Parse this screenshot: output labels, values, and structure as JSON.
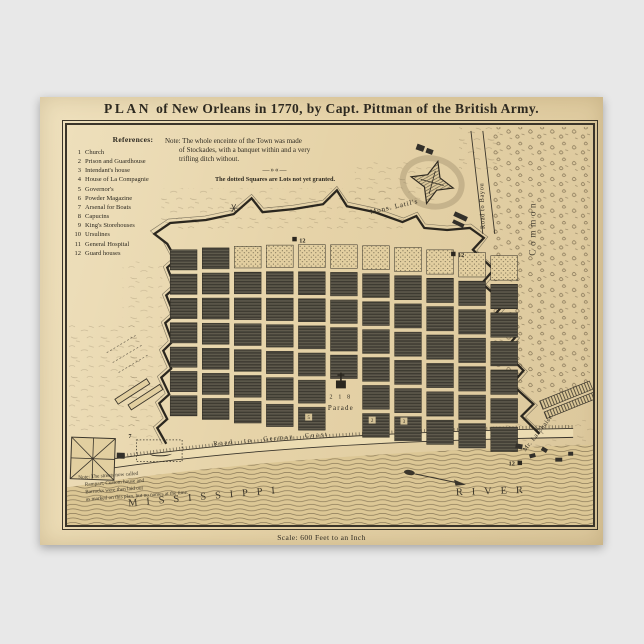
{
  "page": {
    "background_color": "#e8e8e8"
  },
  "poster": {
    "title_word": "PLAN",
    "title_rest": "of New Orleans in 1770, by Capt. Pittman of the British Army.",
    "scale_text": "Scale: 600 Feet to an Inch"
  },
  "references": {
    "heading": "References:",
    "items": [
      {
        "num": "1",
        "label": "Church"
      },
      {
        "num": "2",
        "label": "Prison and Guardhouse"
      },
      {
        "num": "3",
        "label": "Intendant's house"
      },
      {
        "num": "4",
        "label": "House of La Compagnie"
      },
      {
        "num": "5",
        "label": "Governor's"
      },
      {
        "num": "6",
        "label": "Powder Magazine"
      },
      {
        "num": "7",
        "label": "Arsenal for Boats"
      },
      {
        "num": "8",
        "label": "Capucins"
      },
      {
        "num": "9",
        "label": "King's Storehouses"
      },
      {
        "num": "10",
        "label": "Ursulines"
      },
      {
        "num": "11",
        "label": "General Hospital"
      },
      {
        "num": "12",
        "label": "Guard houses"
      }
    ]
  },
  "stockade_note": {
    "line1": "Note: The whole enceinte of the Town was made",
    "line2": "of Stockades, with a banquet within and a very",
    "line3": "trifling ditch without.",
    "divider": "—»«—",
    "dotted_squares": "The dotted Squares are Lots not yet granted."
  },
  "streets_note": {
    "line1": "Note: The streets now called",
    "line2": "Rampart, Custom house and",
    "line3": "Barracks were then laid out",
    "line4": "as marked on this plan, but no names at the time."
  },
  "labels": {
    "mons_latils": "Mons. Latil's",
    "road_to_bayou": "Road to Bayou",
    "common": "Common",
    "road_german_coast": "Road to German Coast",
    "mississippi": "MISSISSIPPI",
    "river": "RIVER",
    "parade": "Parade",
    "parade_numbers": "2 1 8",
    "mr_la_chaise": "Mr. La Chaise",
    "guard_house_marker": "12",
    "arsenal_marker": "7",
    "block_5": "5",
    "block_2": "2",
    "block_3": "3"
  },
  "map_grid": {
    "cols": 11,
    "rows": 7,
    "dotted_top_row_from_col": 2,
    "parade_col": 5,
    "parade_rows_open": [
      5,
      6
    ]
  },
  "colors": {
    "page_bg": "#e8e8e8",
    "paper": "#e6d3a8",
    "ink": "#2d2920",
    "block": "#4f4b40",
    "water": "#dcc795",
    "water_line": "#77684a",
    "terrain": "#6f6045",
    "wall": "#2b271f"
  }
}
